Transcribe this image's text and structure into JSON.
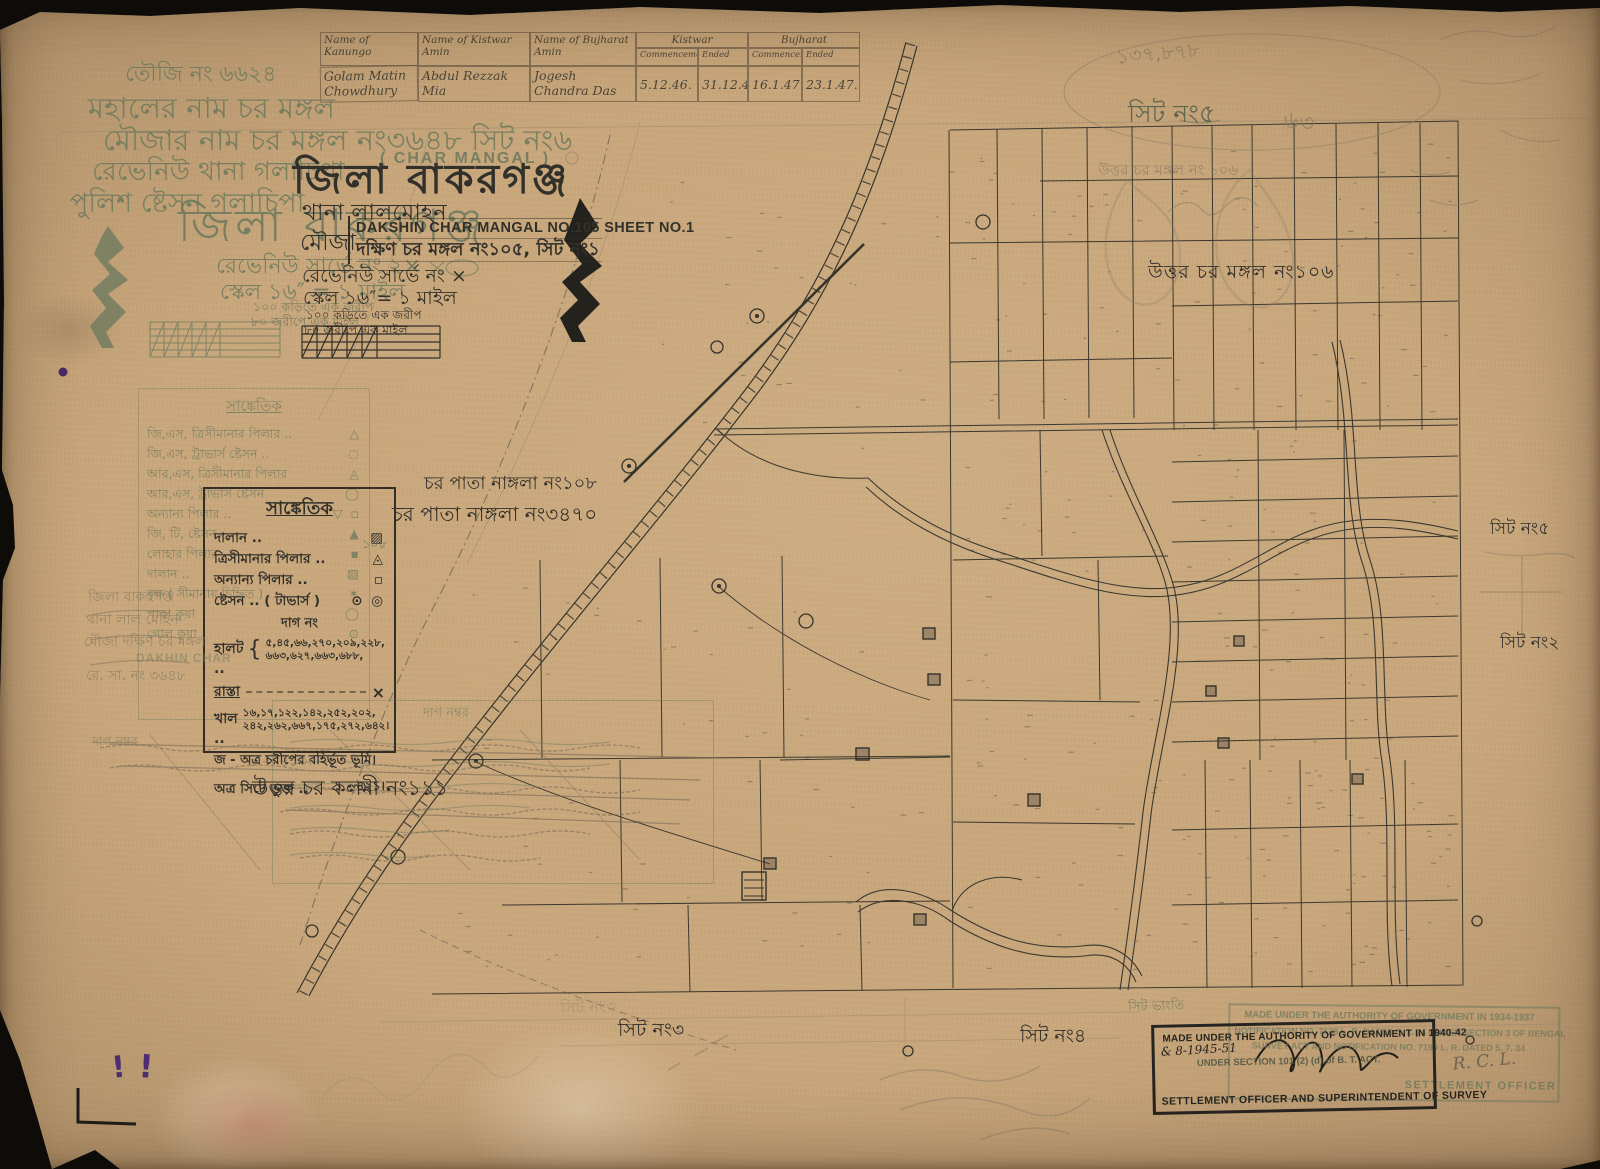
{
  "colors": {
    "ink": "#32302a",
    "green": "#6e7a5e",
    "pencil": "#877b64",
    "paper": "#c9a77c",
    "purple": "#4f2d73"
  },
  "table": {
    "col1": "Name of Kanungo",
    "col2": "Name of Kistwar Amin",
    "col3": "Name of Bujharat Amin",
    "grp1": "Kistwar",
    "grp2": "Bujharat",
    "sub": [
      "Commencement",
      "Ended",
      "Commencement",
      "Ended"
    ],
    "row": [
      "Golam Matin Chowdhury",
      "Abdul Rezzak Mia",
      "Jogesh Chandra Das",
      "5.12.46.",
      "31.12.46.",
      "16.1.47.",
      "23.1.47."
    ]
  },
  "green_header": {
    "touzi": "তৌজি নং ৬৬২৪",
    "mahal": "মহালের নাম  চর মঙ্গল",
    "mouza": "মৌজার নাম  চর মঙ্গল নং৩৬৪৮  সিট নং৬",
    "char_en": "( CHAR MANGAL )",
    "rthana": "রেভেনিউ থানা  গলাচিপা",
    "pstn": "পুলিশ ষ্টেসন  গলাচিপা",
    "zila": "জিলা বাকরগঞ্জ",
    "rs": "রেভেনিউ সার্ভে নং ২×",
    "scale": "স্কেল ১৬″ = ১ মাইল",
    "n1": "১০০ কড়িতে এক জরীপ",
    "n2": "৮০ জরীপে এক মাইল"
  },
  "ink_header": {
    "zila": "জিলা বাকরগঞ্জ",
    "thana": "থানা  লালমোহন",
    "mouza_lbl": "মৌজা",
    "title_en": "DAKSHIN CHAR MANGAL NO.105 SHEET NO.1",
    "title_bn": "দক্ষিণ চর মঙ্গল নং১০৫, সিট নং১",
    "rs": "রেভেনিউ সার্ভে নং ×",
    "scale": "স্কেল ১৬″= ১ মাইল",
    "n1": "১০০ কড়িতে এক জরীপ",
    "n2": "৮০ জরীপে এক মাইল"
  },
  "legend_ink": {
    "title": "সাঙ্কেতিক",
    "items": [
      {
        "label": "দালান ..",
        "sym": "▨"
      },
      {
        "label": "ত্রিসীমানার পিলার ..",
        "sym": "◬"
      },
      {
        "label": "অন্যান্য পিলার ..",
        "sym": "▫"
      },
      {
        "label": "ষ্টেসন .. ( টাভার্স )",
        "sym": "⊙ ◎"
      }
    ],
    "dag": "দাগ নং",
    "halot": "হালট ..",
    "halot_nos1": "৫,৪৫,৬৬,২৭০,২০৯,২২৮,",
    "halot_nos2": "৬৬৩,৬২৭,৬৬৩,৬৮৮,",
    "rasta": "রাস্তা",
    "rasta_x": "×",
    "khal": "খাল ..",
    "khal_nos1": "১৬,১৭,১২২,১৪২,২৫২,২০২,",
    "khal_nos2": "২৪২,২৬২,৬৬৭,১৭৫,২৭২,৬৪২।",
    "ja": "জ - অত্র চরীপের বহির্ভূত ভূমি।",
    "bhukta": "অত্র সিটে ভুক্ত ..",
    "bhukta_val": "১ - ৪২১।"
  },
  "legend_green": {
    "title": "সাঙ্কেতিক",
    "items": [
      {
        "label": "জি,এস, ত্রিসীমানার পিলার ..",
        "sym": "△"
      },
      {
        "label": "জি,এস, ট্রাভার্স ষ্টেসন ..",
        "sym": "◌"
      },
      {
        "label": "আর,এস, ত্রিসীমানার পিলার",
        "sym": "◬"
      },
      {
        "label": "আর,এস, ট্রাভার্স ষ্টেসন",
        "sym": "◯"
      },
      {
        "label": "অন্যান্য পিলার ..",
        "sym": "▽ ▫"
      },
      {
        "label": "জি, টি, ষ্টেসন",
        "sym": "▲"
      },
      {
        "label": "লোহার পিলার",
        "sym": "▪"
      },
      {
        "label": "দালান ..",
        "sym": "▨"
      },
      {
        "label": "বৃক্ষ ( সীমানায় চিহ্নিত )",
        "sym": "✶"
      },
      {
        "label": "পাকা কুয়া",
        "sym": "◯"
      },
      {
        "label": "গোল কুয়া",
        "sym": "⊙"
      }
    ]
  },
  "dag_box": {
    "title": "দাগ নম্বর"
  },
  "map_labels": {
    "uttar_mangal": "উত্তর চর মঙ্গল নং১০৬",
    "pata_108": "চর পাতা নাঙ্গলা নং১০৮",
    "pata_3470": "চর পাতা নাঙ্গলা নং৩৪৭০",
    "n108": "১০৮",
    "kalmi": "উত্তর চর কলমী নং১১১",
    "sheet2": "সিট নং২",
    "sheet3": "সিট নং৩",
    "sheet4": "সিট নং৪",
    "sheet5": "সিট নং৫"
  },
  "pencil": {
    "tr1": "১৩৭,৮৭৮",
    "tr_sheet": "সিট নং৫",
    "tr_63": "৬৩",
    "tr_mouza": "উত্তর চর মঙ্গল নং ১০৬",
    "lb1": "জিলা বাকরগঞ্জ",
    "lb2": "থানা লাল মোহন",
    "lb3": "মৌজা দক্ষিণ চর মঙ্গল",
    "lb3_en": "DAKHIN CHAR",
    "lb4": "রে. সা. নং ৩৬৪৮",
    "dag_no": "দাগ নম্বর",
    "v413": "১ — ৪১৩।",
    "sit_bhangti": "সিট ভাংতি",
    "ghost_sheet3": "সিট নং৩"
  },
  "stamps": {
    "ink": {
      "l1": "MADE UNDER THE AUTHORITY OF GOVERNMENT IN 1940-42",
      "l2": "& 8-1945-51",
      "l3": "UNDER SECTION 101 (2) (d) of B. T. ACT.",
      "officer": "SETTLEMENT OFFICER AND SUPERINTENDENT OF SURVEY"
    },
    "green": {
      "l1": "MADE UNDER THE AUTHORITY OF GOVERNMENT IN 1934-1937",
      "l2": "NOTIFICATION NO. 7129 L. R. DATED 5. 7. 34 UNDER SECTION 3 OF BENGAL",
      "l3": "SURVEY ACT AND NOTIFICATION NO. 7190 L. R. DATED 5. 7. 34",
      "sig": "R. C. L.",
      "officer": "SETTLEMENT OFFICER"
    }
  }
}
